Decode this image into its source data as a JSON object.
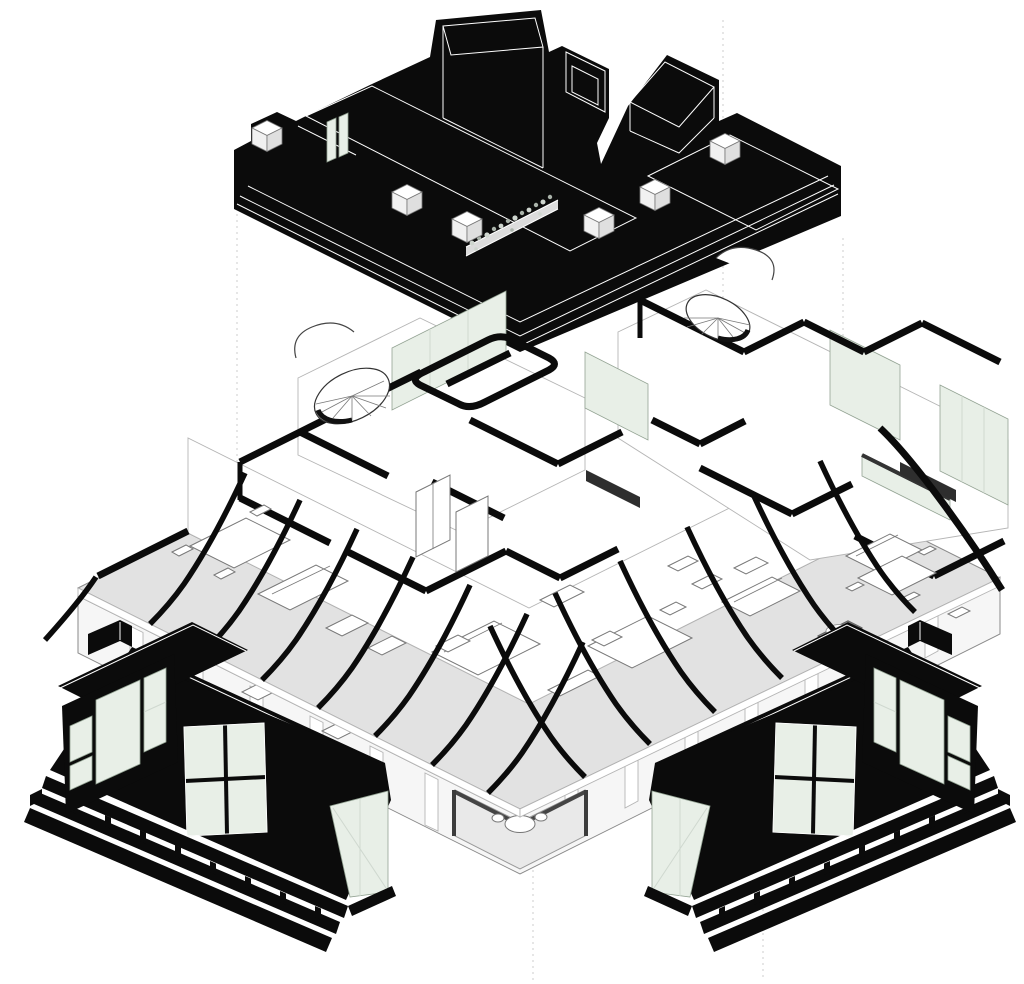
{
  "diagram": {
    "type": "exploded-axonometric-architecture",
    "subject": "attic level of a corner building: roof slab, furnished attic floor plan, two mansard facade panels",
    "text_labels": []
  },
  "colors": {
    "ink": "#0b0b0b",
    "paper": "#ffffff",
    "glass": "#e8efe7",
    "floor": "#e2e2e2",
    "underfloor": "#f6f6f6",
    "line": "#8a8a8a",
    "furn": "#787878",
    "guide": "#cccccc",
    "dark": "#2e2e2e",
    "plant": "#aab3aa"
  },
  "parts": {
    "roof": {
      "chimney_count": 6,
      "features": [
        "stair-bulkhead-tower",
        "secondary-bulkhead",
        "right-tower",
        "roof-planter-strip",
        "terrace-glass-door",
        "parapet-steps"
      ]
    },
    "floor_plan": {
      "features": [
        "corridor-loop-walls",
        "spiral-stair-left",
        "spiral-stair-right",
        "mansard-ribs",
        "balcony-round-table",
        "sofas",
        "beds",
        "dining-tables",
        "bathtub",
        "wardrobes",
        "glass-partitions",
        "under-floor-columns"
      ],
      "rib_count_left": 7,
      "rib_count_right": 7
    },
    "facade_left": {
      "features": [
        "dormer-window",
        "four-pane-window",
        "corner-glazing",
        "cornice-railing",
        "ridge-cap"
      ]
    },
    "facade_right": {
      "features": [
        "dormer-window",
        "four-pane-window",
        "corner-glazing",
        "cornice-railing",
        "ridge-cap"
      ],
      "mirrored_of": "facade_left"
    }
  }
}
